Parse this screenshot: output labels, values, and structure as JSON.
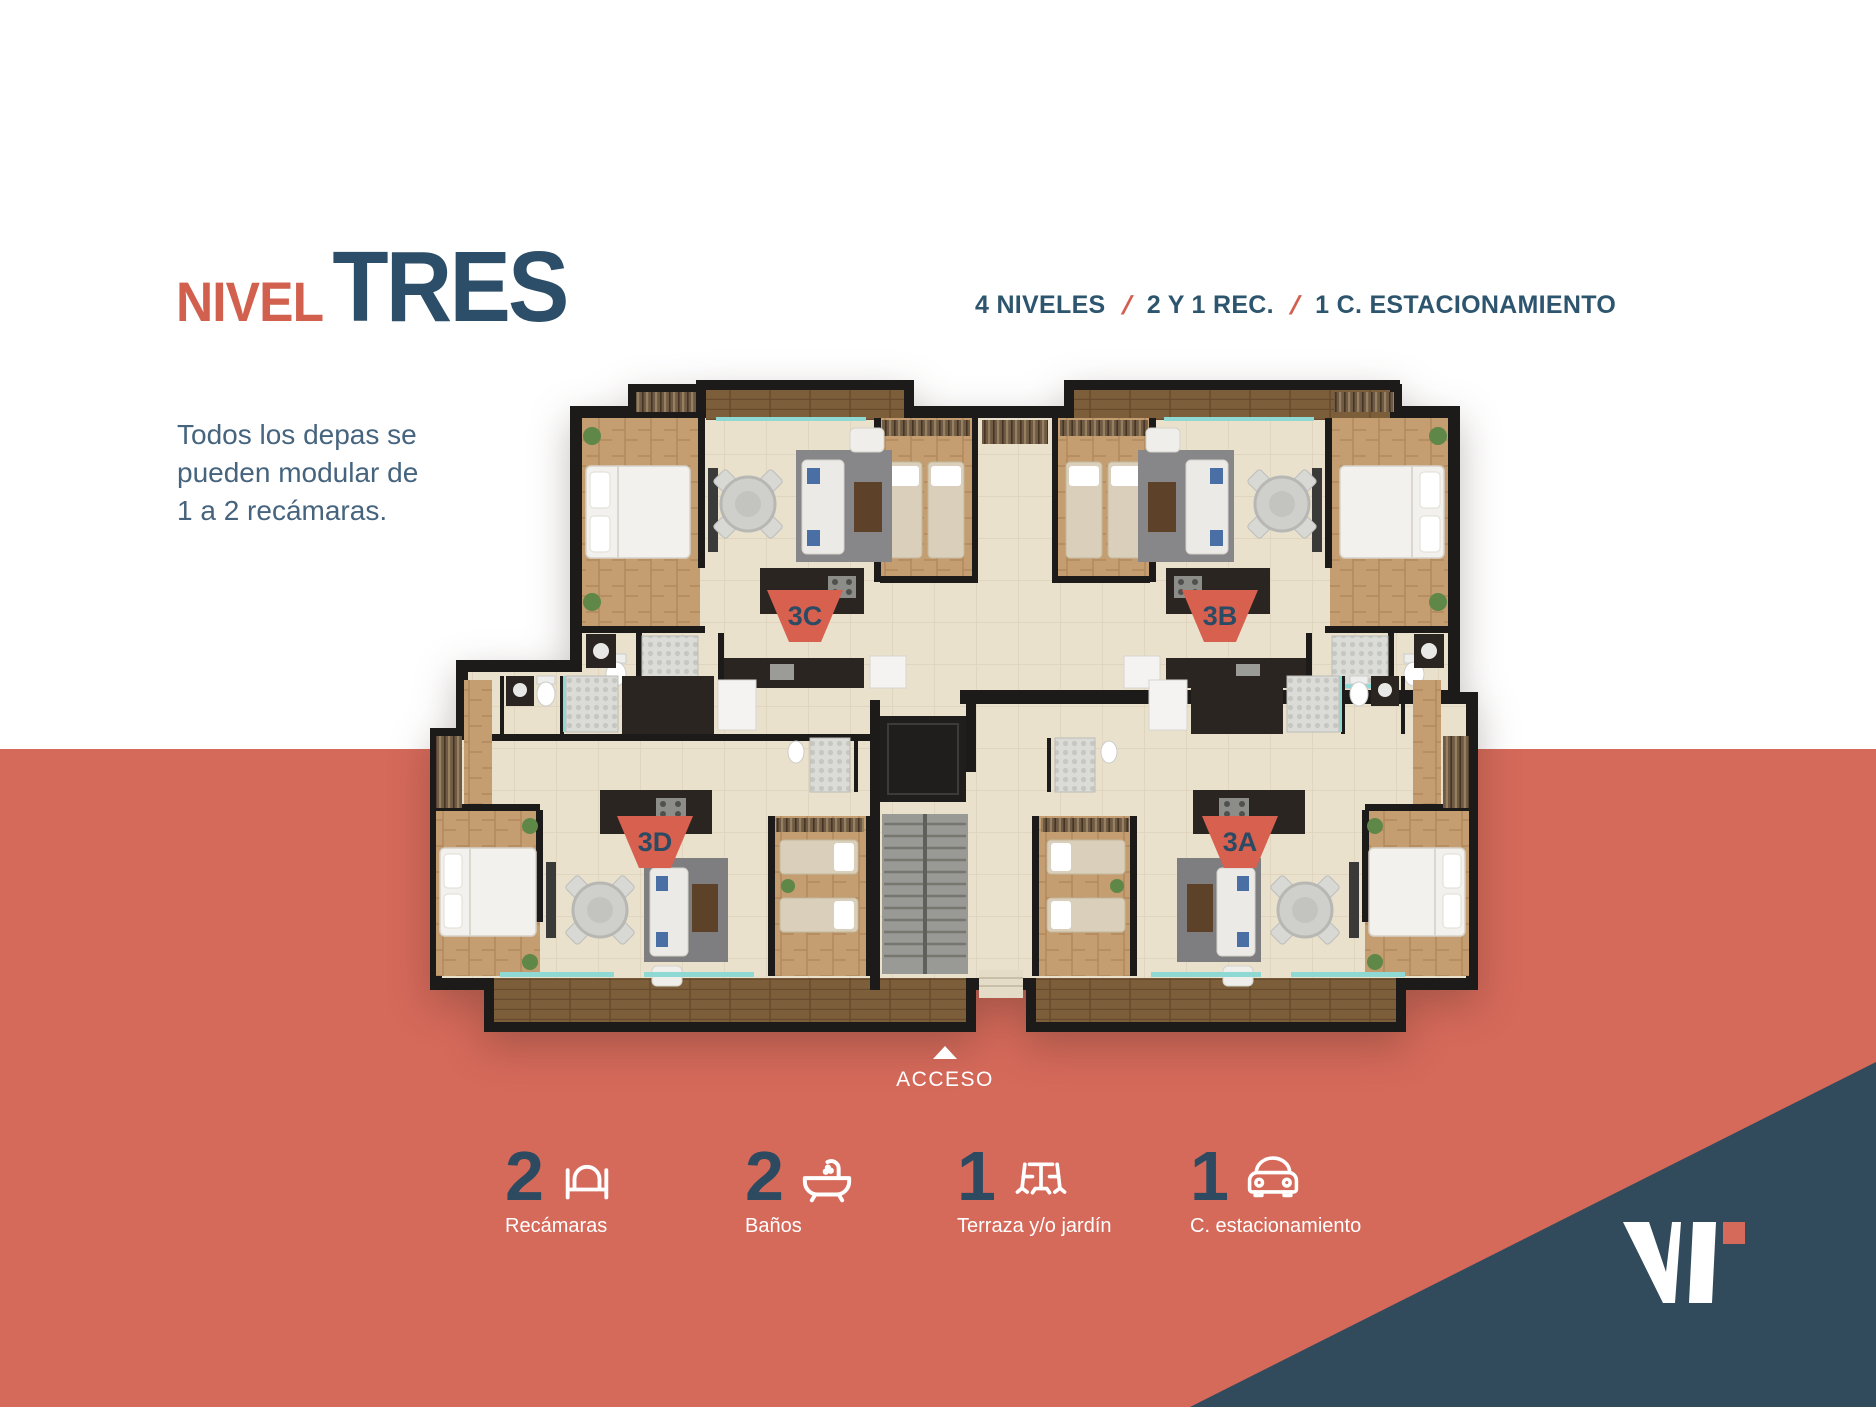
{
  "slide": {
    "title": {
      "prefix": "NIVEL",
      "main": "TRES"
    },
    "specs": {
      "separator": "/",
      "items": [
        "4 NIVELES",
        "2 Y 1 REC.",
        "1 C. ESTACIONAMIENTO"
      ]
    },
    "description": {
      "lines": [
        "Todos los depas se",
        "pueden modular de",
        "1 a 2 recámaras."
      ]
    }
  },
  "floor_plan": {
    "access_label": "ACCESO",
    "units": [
      {
        "id": "3C"
      },
      {
        "id": "3B"
      },
      {
        "id": "3D"
      },
      {
        "id": "3A"
      }
    ]
  },
  "stats": [
    {
      "value": "2",
      "label": "Recámaras",
      "icon": "bed-icon"
    },
    {
      "value": "2",
      "label": "Baños",
      "icon": "bathtub-icon"
    },
    {
      "value": "1",
      "label": "Terraza y/o jardín",
      "icon": "terrace-icon"
    },
    {
      "value": "1",
      "label": "C. estacionamiento",
      "icon": "car-icon"
    }
  ],
  "colors": {
    "coral_band": "#d5695a",
    "navy_triangle": "#314a5c",
    "title_accent": "#d2604f",
    "title_main": "#2d4e68",
    "text_blue": "#46647d",
    "badge": "#d8604f",
    "window_teal": "#8fd9d4"
  }
}
